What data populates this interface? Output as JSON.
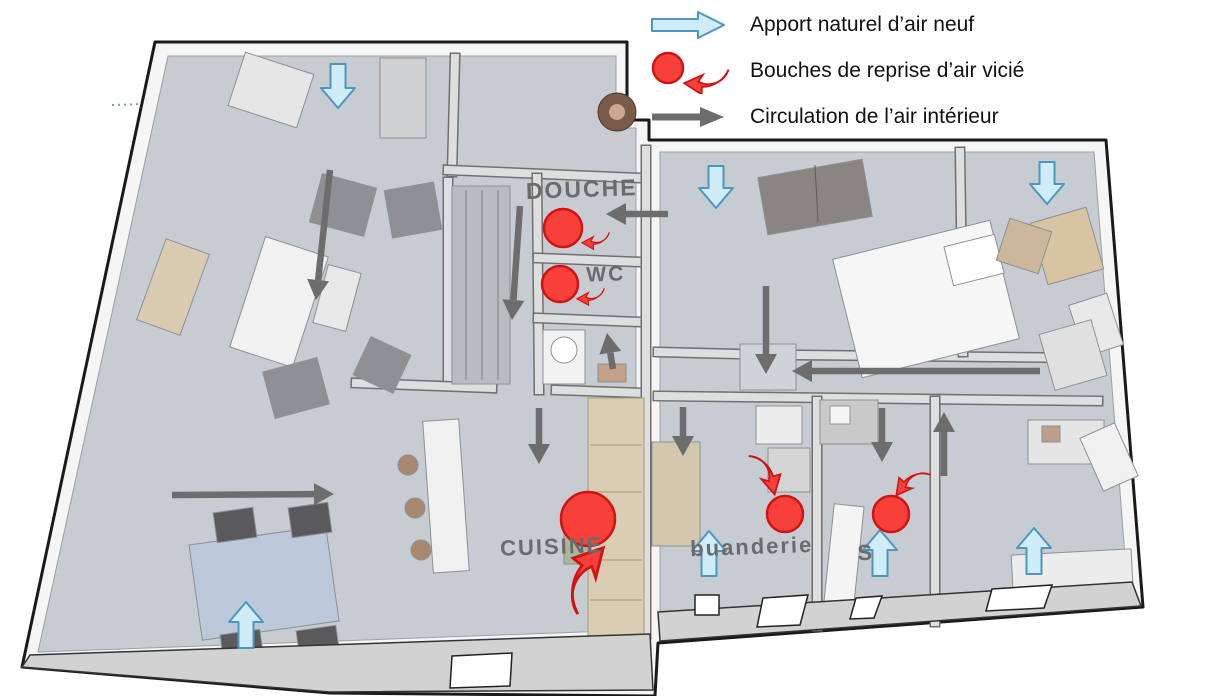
{
  "title": "Schéma de ventilation d'une maison (vue 3D)",
  "legend": {
    "items": [
      {
        "id": "fresh-air",
        "icon": "blue-arrow-icon",
        "label": "Apport naturel d’air neuf"
      },
      {
        "id": "extraction",
        "icon": "red-vent-icon",
        "label": "Bouches de reprise d’air vicié"
      },
      {
        "id": "circulation",
        "icon": "gray-arrow-icon",
        "label": "Circulation de l’air intérieur"
      }
    ]
  },
  "colors": {
    "fresh_air_fill": "#cfecf9",
    "fresh_air_stroke": "#4e96bd",
    "extraction_fill": "#f8403a",
    "extraction_stroke": "#d01313",
    "circulation": "#6d6d6d",
    "floor": "#c6ccd2",
    "wall_light": "#dddedf",
    "wall_dark": "#707070",
    "outline": "#1a1a1a",
    "label": "#6b6b6b"
  },
  "room_labels": [
    {
      "text": "DOUCHE",
      "x": 582,
      "y": 197,
      "size": 23,
      "rot": -2
    },
    {
      "text": "WC",
      "x": 606,
      "y": 281,
      "size": 21,
      "rot": -2
    },
    {
      "text": "CUISINE",
      "x": 552,
      "y": 554,
      "size": 22,
      "rot": -2
    },
    {
      "text": "buanderie",
      "x": 752,
      "y": 554,
      "size": 22,
      "rot": -2
    },
    {
      "text": "S",
      "x": 866,
      "y": 560,
      "size": 22,
      "rot": -2
    }
  ],
  "fresh_air_arrows": [
    {
      "x1": 338,
      "y1": 64,
      "x2": 338,
      "y2": 108
    },
    {
      "x1": 716,
      "y1": 166,
      "x2": 716,
      "y2": 208
    },
    {
      "x1": 1047,
      "y1": 162,
      "x2": 1047,
      "y2": 204
    },
    {
      "x1": 246,
      "y1": 648,
      "x2": 246,
      "y2": 602
    },
    {
      "x1": 709,
      "y1": 576,
      "x2": 709,
      "y2": 531
    },
    {
      "x1": 880,
      "y1": 576,
      "x2": 880,
      "y2": 530
    },
    {
      "x1": 1034,
      "y1": 574,
      "x2": 1034,
      "y2": 528
    }
  ],
  "circulation_arrows": [
    {
      "x1": 330,
      "y1": 170,
      "x2": 316,
      "y2": 300
    },
    {
      "x1": 668,
      "y1": 214,
      "x2": 606,
      "y2": 214
    },
    {
      "x1": 520,
      "y1": 206,
      "x2": 512,
      "y2": 320
    },
    {
      "x1": 613,
      "y1": 369,
      "x2": 607,
      "y2": 333
    },
    {
      "x1": 766,
      "y1": 286,
      "x2": 766,
      "y2": 374
    },
    {
      "x1": 1040,
      "y1": 371,
      "x2": 792,
      "y2": 371
    },
    {
      "x1": 539,
      "y1": 408,
      "x2": 539,
      "y2": 464
    },
    {
      "x1": 683,
      "y1": 407,
      "x2": 683,
      "y2": 456
    },
    {
      "x1": 882,
      "y1": 408,
      "x2": 882,
      "y2": 462
    },
    {
      "x1": 944,
      "y1": 476,
      "x2": 944,
      "y2": 412
    },
    {
      "x1": 172,
      "y1": 495,
      "x2": 334,
      "y2": 494
    }
  ],
  "extraction_points": [
    {
      "cx": 563,
      "cy": 228,
      "r": 19,
      "hook": {
        "x": 583,
        "y": 242,
        "rot": 8,
        "s": 0.95,
        "flip": false
      }
    },
    {
      "cx": 560,
      "cy": 284,
      "r": 18,
      "hook": {
        "x": 578,
        "y": 298,
        "rot": 8,
        "s": 0.95,
        "flip": false
      }
    },
    {
      "cx": 588,
      "cy": 519,
      "r": 27,
      "hook": {
        "x": 603,
        "y": 551,
        "rot": 140,
        "s": 2.3,
        "flip": false
      }
    },
    {
      "cx": 785,
      "cy": 514,
      "r": 18,
      "hook": {
        "x": 773,
        "y": 493,
        "rot": 265,
        "s": 1.5,
        "flip": false
      }
    },
    {
      "cx": 891,
      "cy": 514,
      "r": 18,
      "hook": {
        "x": 898,
        "y": 495,
        "rot": -60,
        "s": 1.3,
        "flip": true
      }
    }
  ]
}
